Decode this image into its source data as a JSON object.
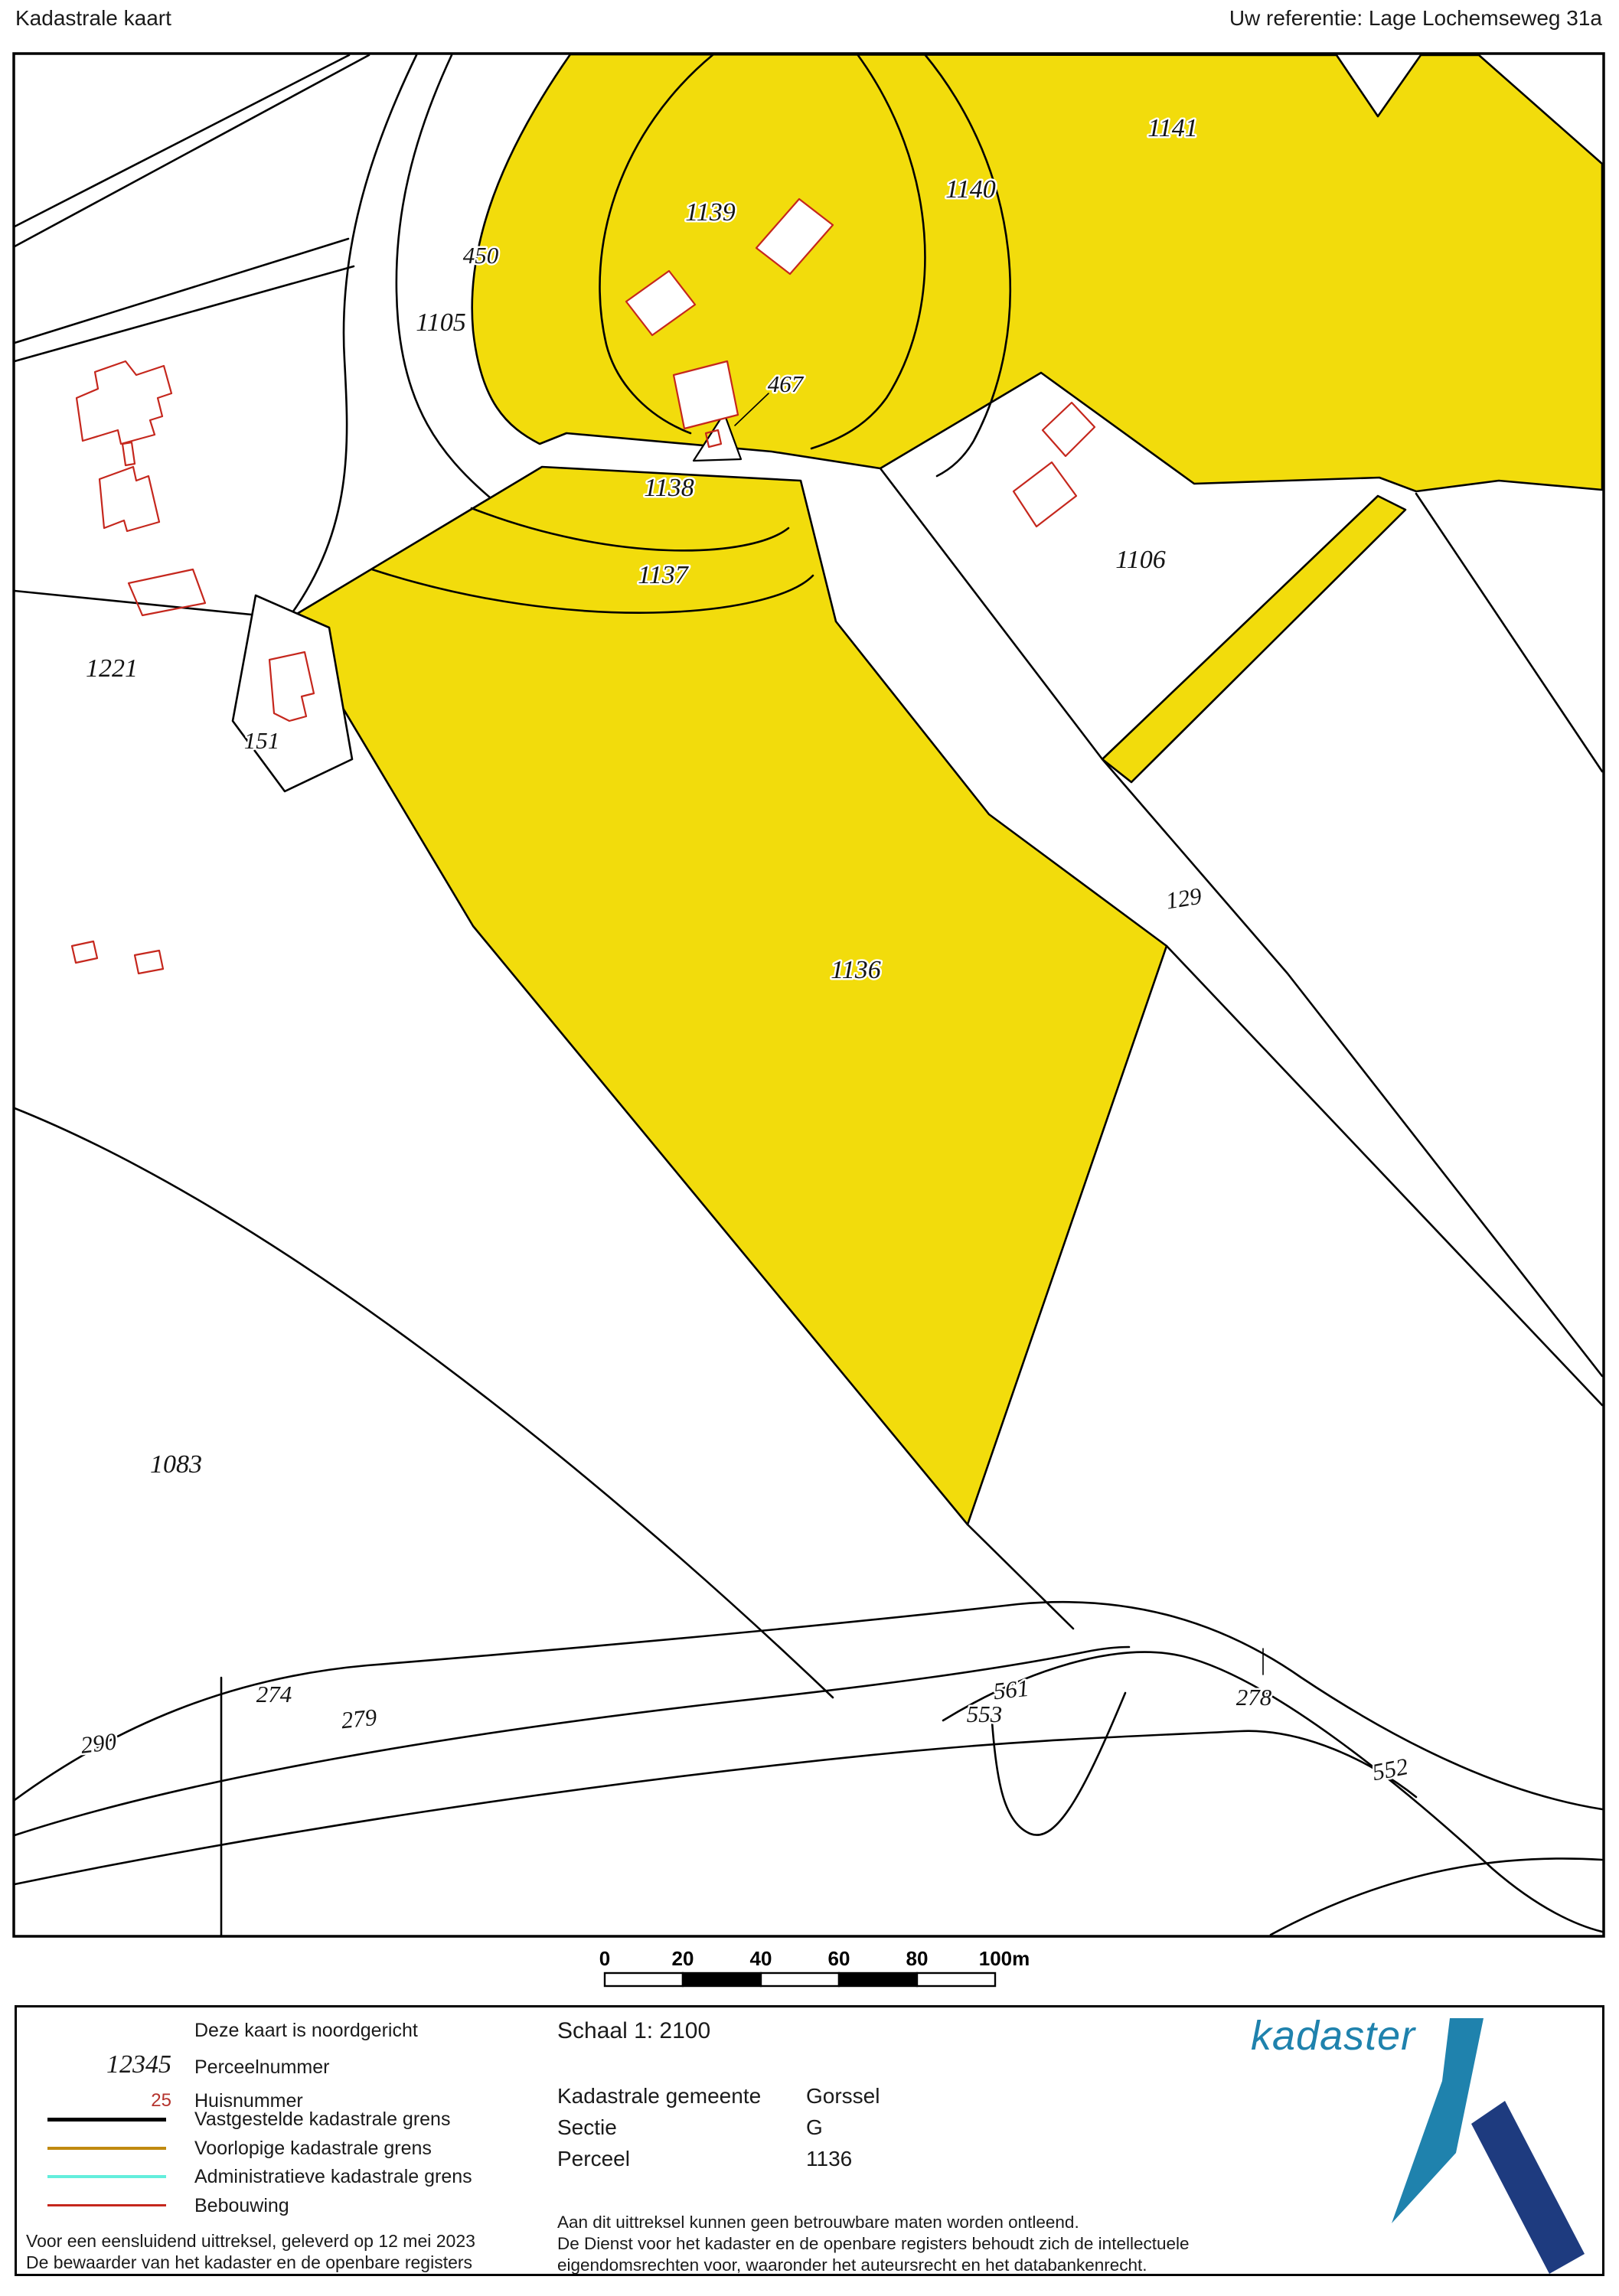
{
  "header": {
    "title": "Kadastrale kaart",
    "reference": "Uw referentie: Lage Lochemseweg 31a"
  },
  "map": {
    "parcels": [
      {
        "id": "1141",
        "label": "1141"
      },
      {
        "id": "1140",
        "label": "1140"
      },
      {
        "id": "1139",
        "label": "1139"
      },
      {
        "id": "450",
        "label": "450"
      },
      {
        "id": "1105",
        "label": "1105"
      },
      {
        "id": "467",
        "label": "467"
      },
      {
        "id": "1138",
        "label": "1138"
      },
      {
        "id": "1137",
        "label": "1137"
      },
      {
        "id": "1106",
        "label": "1106"
      },
      {
        "id": "1221",
        "label": "1221"
      },
      {
        "id": "151",
        "label": "151"
      },
      {
        "id": "129",
        "label": "129"
      },
      {
        "id": "1136",
        "label": "1136"
      },
      {
        "id": "1083",
        "label": "1083"
      },
      {
        "id": "274",
        "label": "274"
      },
      {
        "id": "290",
        "label": "290"
      },
      {
        "id": "279",
        "label": "279"
      },
      {
        "id": "561",
        "label": "561"
      },
      {
        "id": "553",
        "label": "553"
      },
      {
        "id": "278",
        "label": "278"
      },
      {
        "id": "552",
        "label": "552"
      }
    ]
  },
  "scalebar": {
    "ticks": [
      "0",
      "20",
      "40",
      "60",
      "80",
      "100m"
    ]
  },
  "legend": {
    "north_note": "Deze kaart is noordgericht",
    "items": [
      {
        "symbol": "12345",
        "label": "Perceelnummer"
      },
      {
        "symbol": "25",
        "label": "Huisnummer"
      },
      {
        "symbol": "line-black",
        "label": "Vastgestelde kadastrale grens"
      },
      {
        "symbol": "line-orange",
        "label": "Voorlopige kadastrale grens"
      },
      {
        "symbol": "line-cyan",
        "label": "Administratieve kadastrale grens"
      },
      {
        "symbol": "line-red",
        "label": "Bebouwing"
      }
    ],
    "issued_line1": "Voor een eensluidend uittreksel, geleverd op 12 mei 2023",
    "issued_line2": "De bewaarder van het kadaster en de openbare registers"
  },
  "info": {
    "scale_label": "Schaal 1: 2100",
    "rows": [
      {
        "label": "Kadastrale gemeente",
        "value": "Gorssel"
      },
      {
        "label": "Sectie",
        "value": "G"
      },
      {
        "label": "Perceel",
        "value": "1136"
      }
    ],
    "disclaimer1": "Aan dit uittreksel kunnen geen betrouwbare maten worden ontleend.",
    "disclaimer2": "De Dienst voor het kadaster en de openbare registers behoudt zich de intellectuele",
    "disclaimer3": "eigendomsrechten voor, waaronder het auteursrecht en het databankenrecht."
  },
  "logo": {
    "text": "kadaster"
  },
  "colors": {
    "parcel_yellow": "#F2DC0C",
    "boundary_black": "#000000",
    "building_red": "#C5271D",
    "provisional_orange": "#C08A10",
    "administrative_cyan": "#63EEDC",
    "housenumber_red": "#B5332D",
    "logo_blue": "#1F82AD",
    "logo_dark_blue": "#1E3B7F"
  }
}
